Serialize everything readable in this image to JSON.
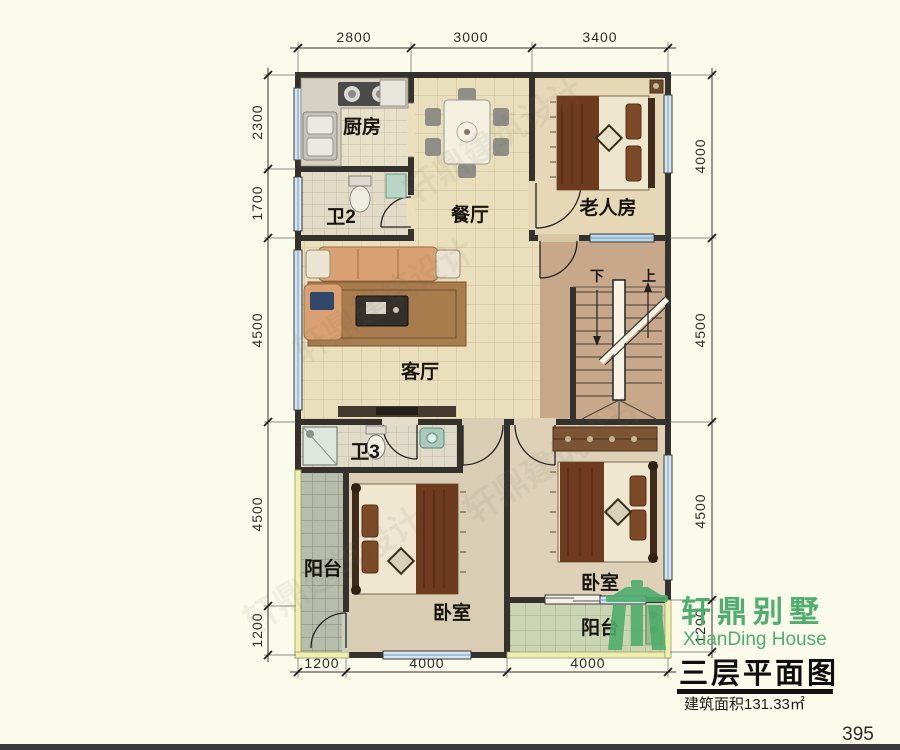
{
  "page": {
    "number": "395",
    "watermark": "轩鼎建筑设计",
    "background": "#fbfbec"
  },
  "title_block": {
    "plan_title": "三层平面图",
    "area_text": "建筑面积131.33㎡"
  },
  "logo": {
    "name_cn": "轩鼎别墅",
    "name_en": "XuanDing House",
    "color": "#4fad6e"
  },
  "rooms": {
    "kitchen": "厨房",
    "bath2": "卫2",
    "dining": "餐厅",
    "elder_room": "老人房",
    "living": "客厅",
    "bath3": "卫3",
    "balcony_left": "阳台",
    "bedroom_bottom": "卧室",
    "bedroom_right": "卧室",
    "balcony_bottom": "阳台"
  },
  "stairs": {
    "down": "下",
    "up": "上"
  },
  "dimensions": {
    "top": [
      "2800",
      "3000",
      "3400"
    ],
    "bottom": [
      "1200",
      "4000",
      "4000"
    ],
    "left": [
      "2300",
      "1700",
      "4500",
      "4500",
      "1200"
    ],
    "right": [
      "4000",
      "4500",
      "4500",
      "1200"
    ]
  },
  "colors": {
    "wall": "#35322e",
    "floor_tile": "#e9dfbc",
    "stair_floor": "#c8a88a",
    "window_glass": "#d5e6f2",
    "balcony_wall": "#eff0b0",
    "logo_green": "#4fad6e"
  }
}
